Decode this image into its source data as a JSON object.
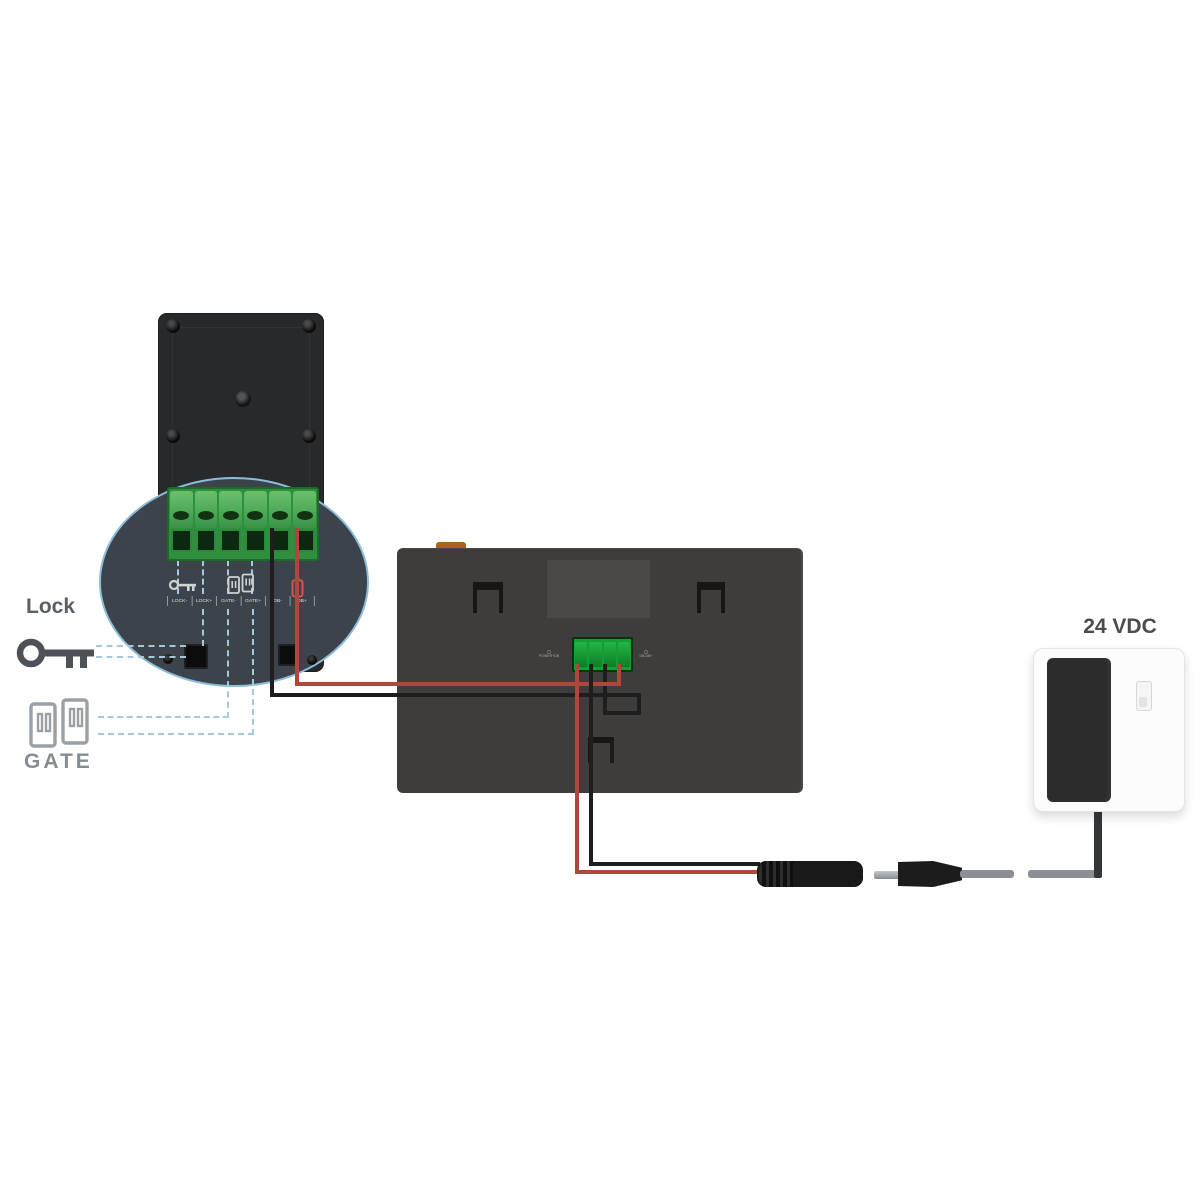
{
  "labels": {
    "lock": "Lock",
    "gate": "GATE",
    "power": "24 VDC"
  },
  "door_station": {
    "terminal_labels": [
      "LOCK-",
      "LOCK+",
      "GATE-",
      "GATE+",
      "DB-",
      "DB+"
    ],
    "icons": [
      "key-icon",
      "gate-door-icon",
      "battery-icon"
    ]
  },
  "monitor": {
    "left_port_label": "POWER+DB",
    "right_port_label": "DB-DB+"
  },
  "colors": {
    "wire_red": "#b0473d",
    "wire_black": "#1e1e1e",
    "dashed_guide": "#a6c9da",
    "terminal_green": "#3f9e4a",
    "callout_ellipse": "#8bbcd9",
    "accent_orange": "#a8641f"
  }
}
